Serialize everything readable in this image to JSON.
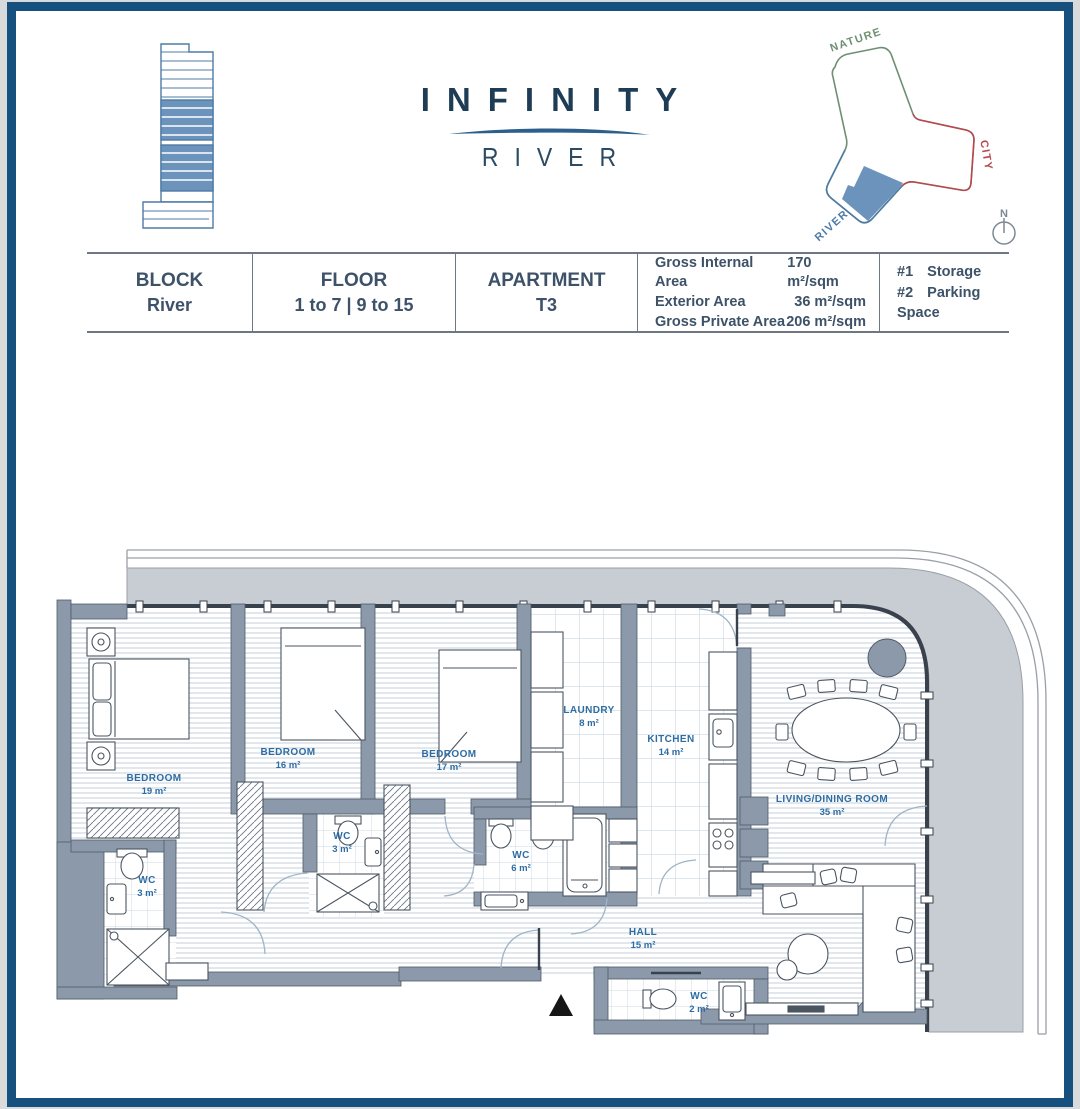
{
  "header": {
    "title": "INFINITY",
    "subtitle": "RIVER"
  },
  "site_diagram": {
    "nature_label": "NATURE",
    "city_label": "CITY",
    "river_label": "RIVER",
    "compass_n": "N"
  },
  "info_table": {
    "block": {
      "label": "BLOCK",
      "value": "River"
    },
    "floor": {
      "label": "FLOOR",
      "value": "1 to 7 | 9 to 15"
    },
    "apartment": {
      "label": "APARTMENT",
      "value": "T3"
    },
    "areas": [
      {
        "label": "Gross Internal Area",
        "value": "170 m²/sqm"
      },
      {
        "label": "Exterior Area",
        "value": "36 m²/sqm"
      },
      {
        "label": "Gross Private Area",
        "value": "206 m²/sqm"
      }
    ],
    "extras": [
      {
        "label": "#1",
        "value": "Storage"
      },
      {
        "label": "#2",
        "value": "Parking Space"
      }
    ]
  },
  "floor_plan": {
    "rooms": [
      {
        "name": "BEDROOM",
        "area": "19 m²"
      },
      {
        "name": "BEDROOM",
        "area": "16 m²"
      },
      {
        "name": "BEDROOM",
        "area": "17 m²"
      },
      {
        "name": "LAUNDRY",
        "area": "8 m²"
      },
      {
        "name": "KITCHEN",
        "area": "14 m²"
      },
      {
        "name": "LIVING/DINING ROOM",
        "area": "35 m²"
      },
      {
        "name": "WC",
        "area": "3 m²"
      },
      {
        "name": "WC",
        "area": "3 m²"
      },
      {
        "name": "WC",
        "area": "6 m²"
      },
      {
        "name": "HALL",
        "area": "15 m²"
      },
      {
        "name": "WC",
        "area": "2 m²"
      }
    ]
  },
  "colors": {
    "navy": "#15507f",
    "title": "#1e3c55",
    "subtitle": "#2b4a63",
    "swoosh": "#2d5f8d",
    "table-text": "#3d5268",
    "table-border": "#6e7884",
    "plan-label": "#2e6da4",
    "wall": "#8b99ab",
    "wall-edge": "#4f5b68",
    "terrace": "#c8cdd4",
    "railing": "#9aa0a8",
    "floor-line": "#dde3ea",
    "tile-line": "#ccd9e4",
    "furniture": "#4a5560",
    "door-arc": "#9fb4c6",
    "brand-blue": "#4d7ba6",
    "brand-fill": "#6b93bb",
    "nature": "#6f8f72",
    "city": "#b8474e",
    "river": "#4d7ba6"
  }
}
